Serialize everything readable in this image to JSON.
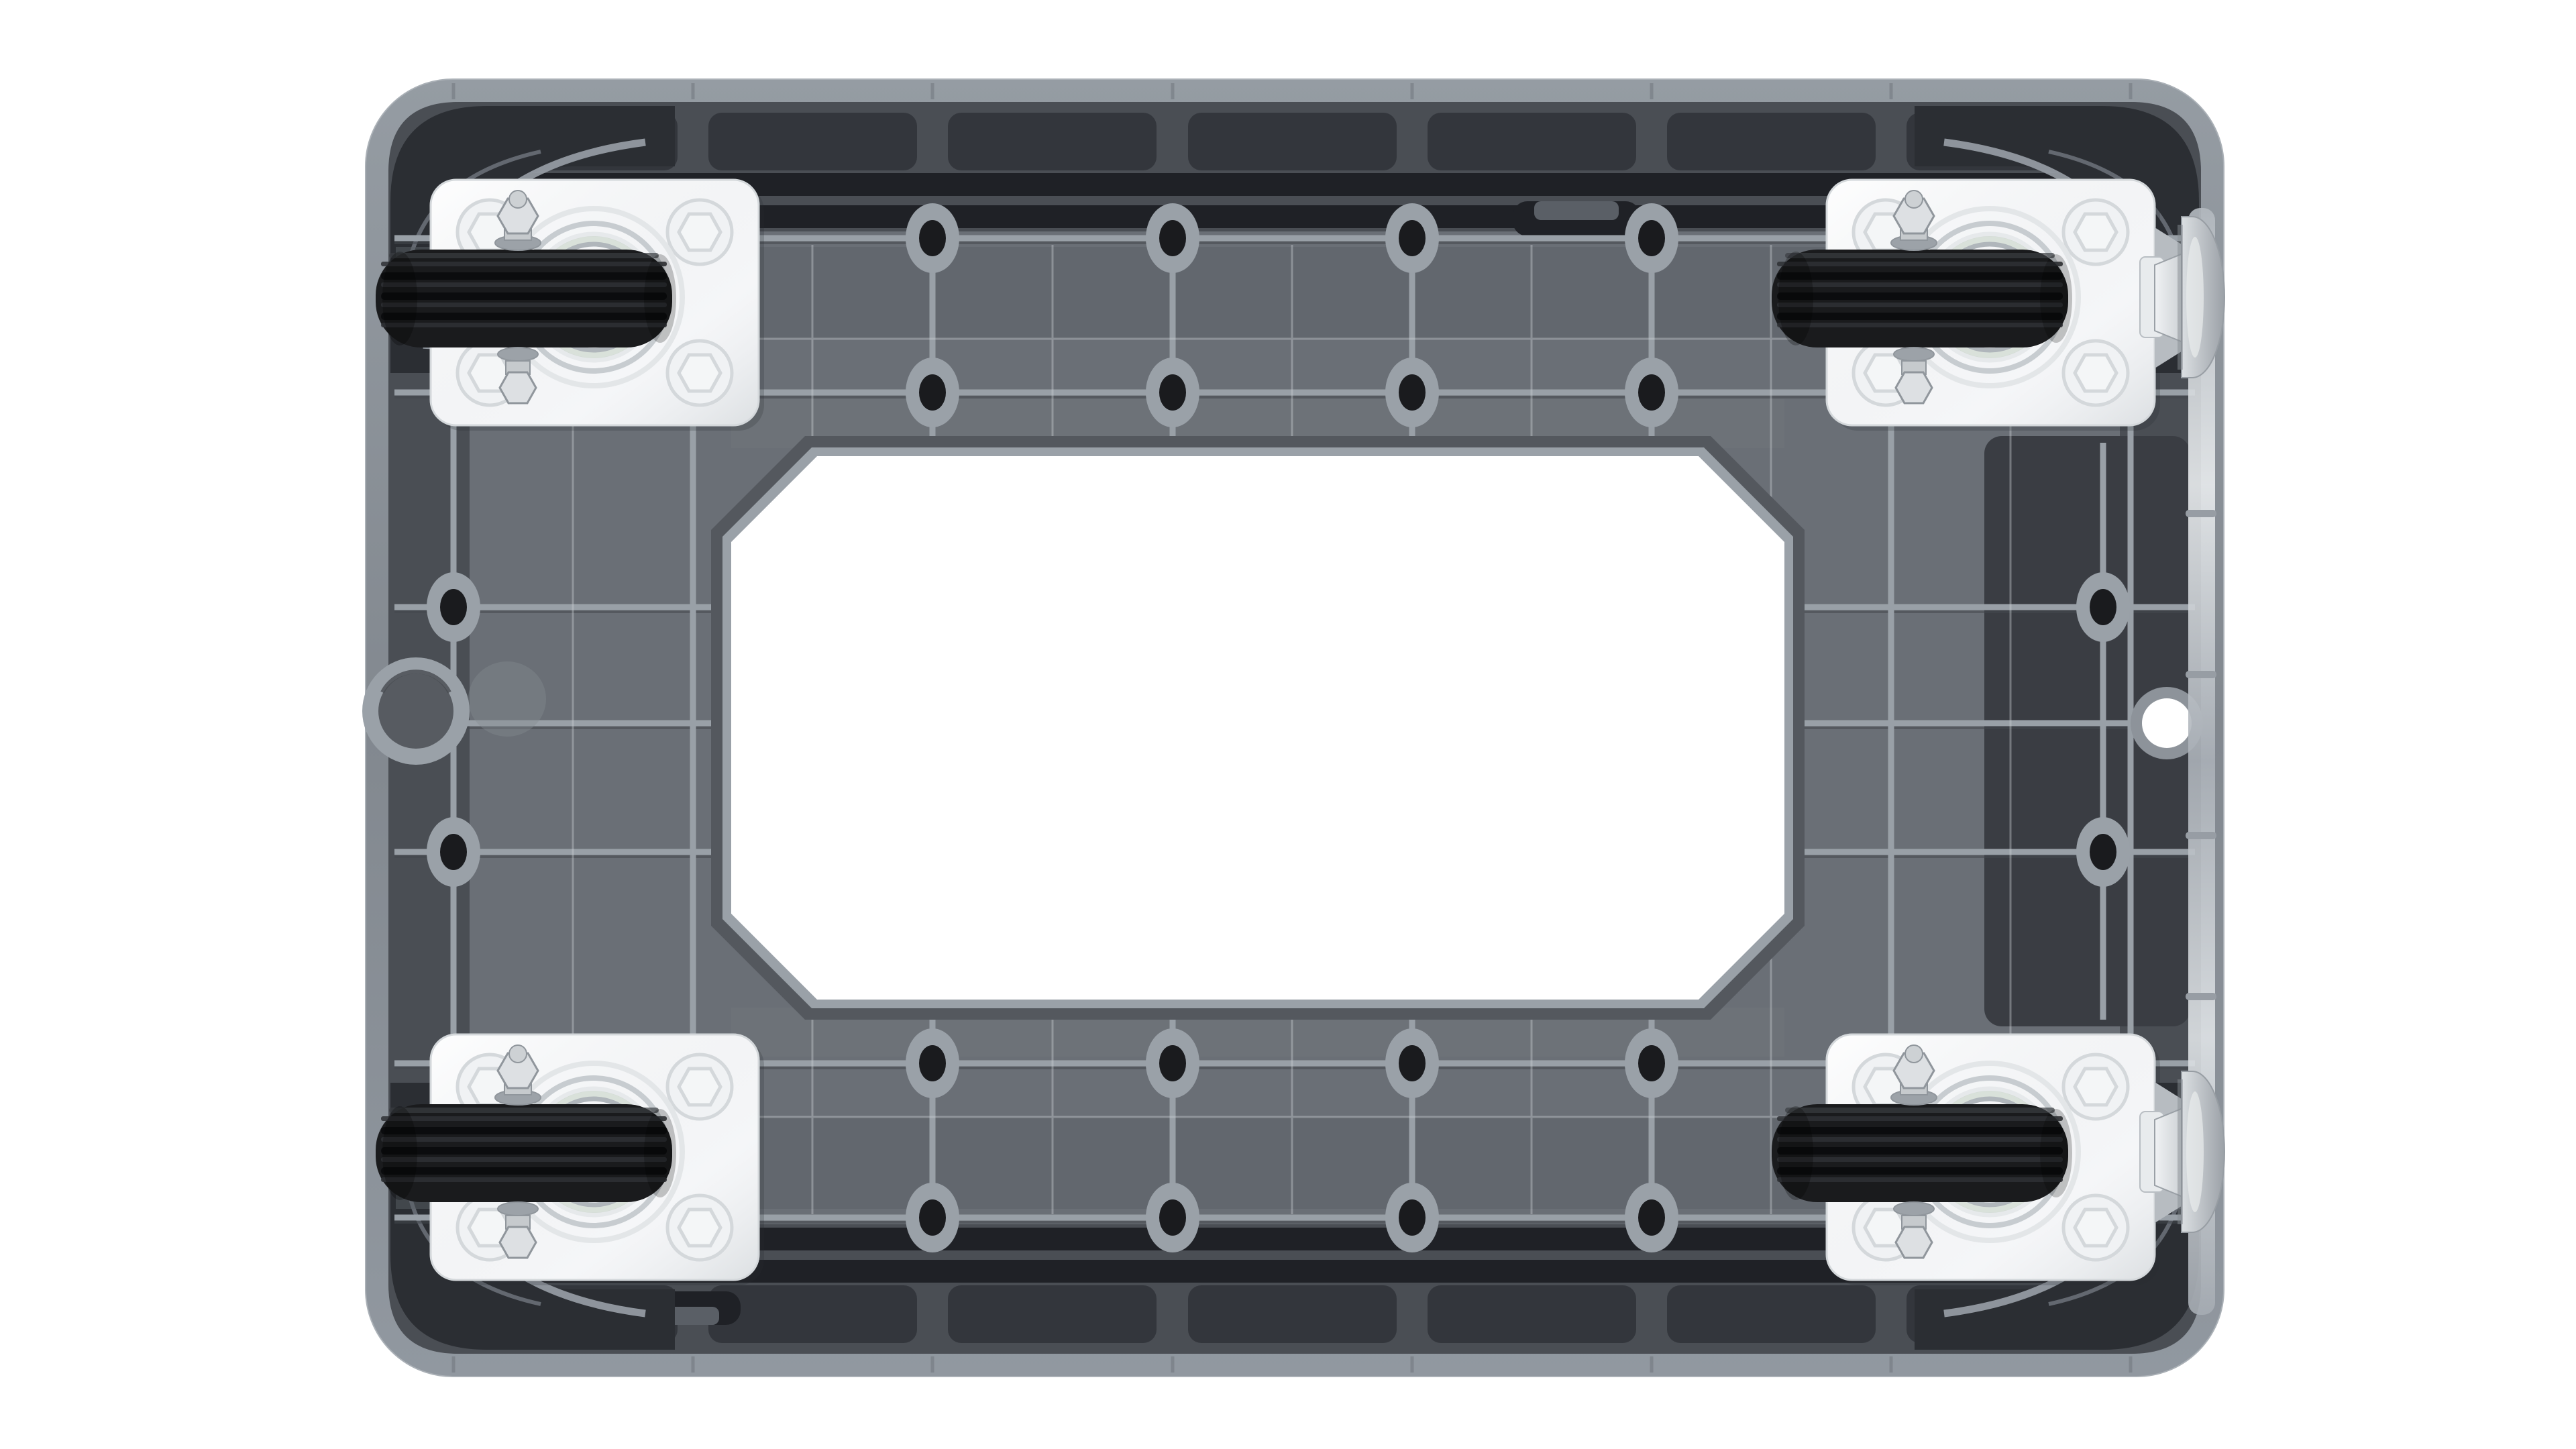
{
  "image": {
    "type": "product-photo",
    "subject": "Underside (bottom view) of a grey plastic platform dolly with four black rubber swivel caster wheels on white square mounting plates; the two right-hand casters have silver brake pedals; a large white octagonal cutout is in the centre of the deck",
    "background_color": "#ffffff"
  },
  "colors": {
    "background": "#ffffff",
    "rim": "#8a9097",
    "body": "#6a6f76",
    "band_dark": "#4a4e54",
    "recess": "#33363c",
    "slot": "#1f2126",
    "corner": "#2b2e33",
    "rib": "#99a0a7",
    "rib_shadow": "#44484e",
    "hairline": "#ccd1d5",
    "panel_shade": "#5a5f66",
    "panel_light": "#71767d",
    "boss_ring": "#9aa1a8",
    "boss_hole": "#1a1b1e",
    "cutout_wall": "#54585e",
    "cutout_rim": "#9aa1a8",
    "cutout": "#ffffff",
    "plate": "#f5f6f8",
    "plate_edge": "#d4d8db",
    "plate_emboss": "#dfe2e5",
    "tire": "#1a1b1d",
    "tread_groove": "#0b0c0e",
    "tread_ridge": "#2f3135",
    "bearing_a": "#c7ccd0",
    "bearing_b": "#e6e9eb",
    "bearing_c": "#b0b6bb",
    "bearing_tint": "#c3cfc3",
    "hardware": "#dde0e3",
    "hardware_dark": "#90969c",
    "pedal_wing": "#b7bcc1",
    "hole_ring": "#8d939a",
    "ghost": "#858b92",
    "tab": "#5a5f66",
    "shine_bar": "#979da4",
    "dark_zone": "#3a3d43"
  },
  "components": {
    "deck": "grey plastic dolly frame",
    "center_cutout_shape": "octagon",
    "casters": [
      {
        "position": "top-left",
        "wheel": "black rubber",
        "plate": "white steel",
        "brake_pedal": false
      },
      {
        "position": "top-right",
        "wheel": "black rubber",
        "plate": "white steel",
        "brake_pedal": true
      },
      {
        "position": "bottom-left",
        "wheel": "black rubber",
        "plate": "white steel",
        "brake_pedal": false
      },
      {
        "position": "bottom-right",
        "wheel": "black rubber",
        "plate": "white steel",
        "brake_pedal": true
      }
    ],
    "screw_boss_rows": 4,
    "side_holes": {
      "left": "round moulded boss",
      "right": "round through-hole"
    }
  }
}
